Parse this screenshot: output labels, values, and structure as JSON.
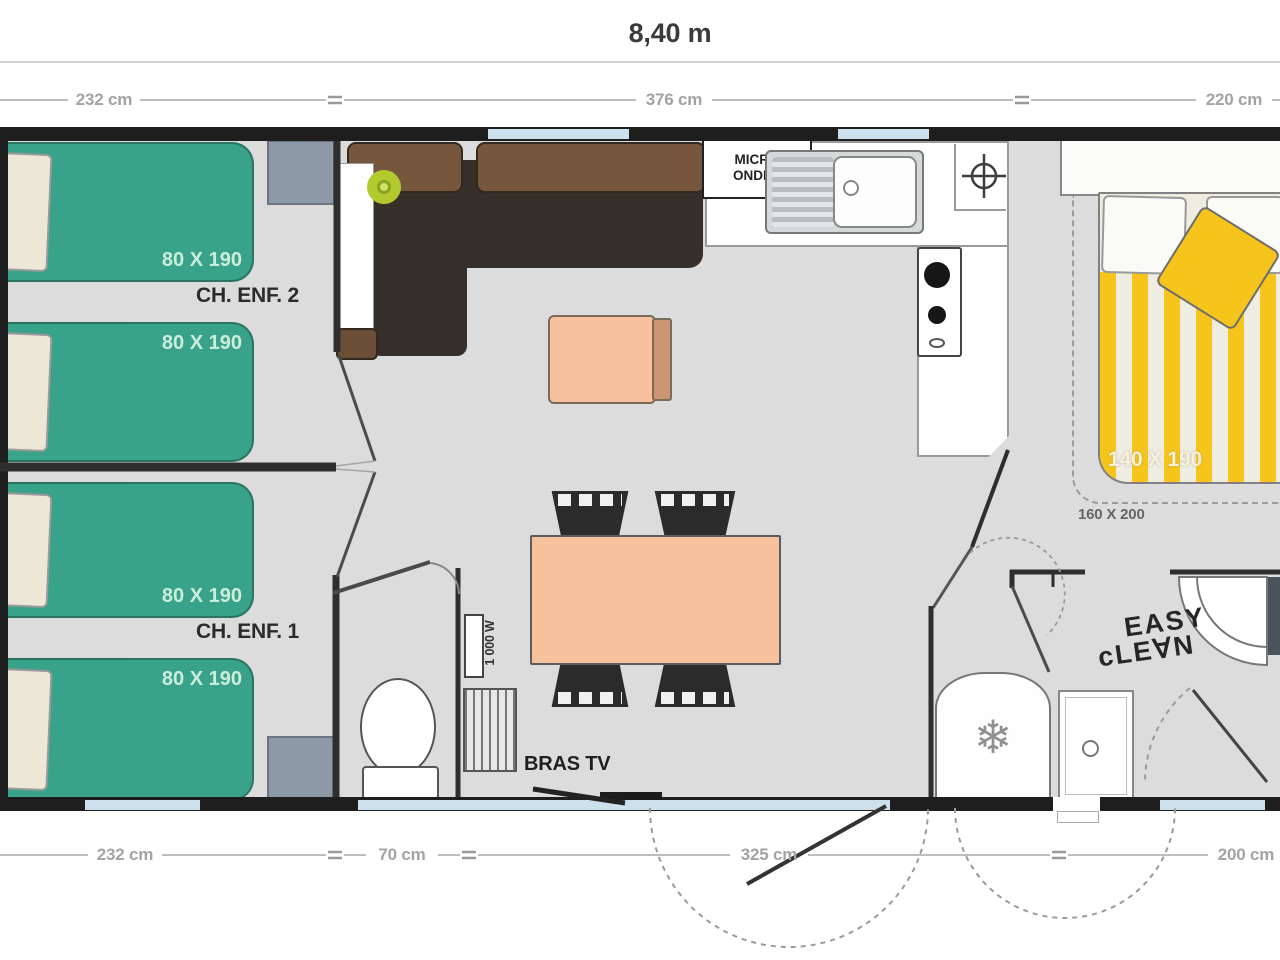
{
  "plan_title": "8,40 m",
  "dimensions": {
    "top": [
      "232 cm",
      "376 cm",
      "220 cm"
    ],
    "bottom": [
      "232 cm",
      "70 cm",
      "325 cm",
      "200 cm"
    ]
  },
  "rooms": {
    "child_bedroom_2": {
      "name": "CH. ENF. 2",
      "bed_top": "80 X 190",
      "bed_bottom": "80 X 190"
    },
    "child_bedroom_1": {
      "name": "CH. ENF. 1",
      "bed_top": "80 X 190",
      "bed_bottom": "80 X 190"
    },
    "master_bedroom": {
      "bed_size": "140 X 190",
      "alt_bed_size": "160 X 200"
    },
    "kitchen": {
      "microwave_line1": "MICRO",
      "microwave_line2": "ONDES"
    },
    "living_room": {
      "tv_bracket": "BRAS TV",
      "water_heater": "1 000 W"
    },
    "bathroom": {
      "brand_line1": "EASY",
      "brand_line2": "cLE∀N"
    }
  },
  "icons": {
    "fridge": "❄"
  },
  "colors": {
    "wall": "#1e1e1e",
    "floor": "#dcdcdc",
    "window": "#cde1ec",
    "kids_bed": "#38a28a",
    "master_bed_stripe": "#f5c51c",
    "table": "#f7c19e",
    "sofa_back": "#76573d",
    "sofa_seat": "#37302a",
    "lamp": "#b3ca2f",
    "wardrobe": "#8d99a5"
  }
}
